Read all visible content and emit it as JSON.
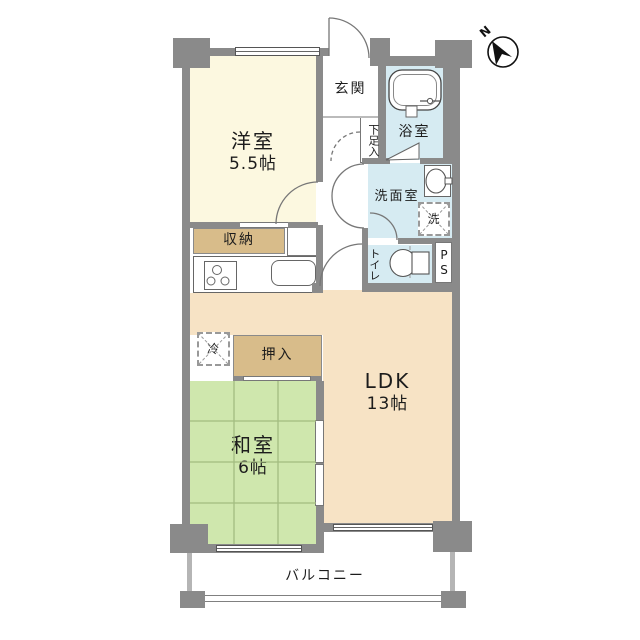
{
  "compass": {
    "north_label": "N"
  },
  "rooms": {
    "western_room": {
      "name": "洋室",
      "size": "5.5帖"
    },
    "ldk": {
      "name": "LDK",
      "size": "13帖"
    },
    "japanese_room": {
      "name": "和室",
      "size": "6帖"
    },
    "entrance": {
      "name": "玄関"
    },
    "bathroom": {
      "name": "浴室"
    },
    "washroom": {
      "name": "洗面室"
    },
    "toilet": {
      "name": "トイレ"
    },
    "balcony": {
      "name": "バルコニー"
    }
  },
  "features": {
    "shoe_cabinet": "下足入",
    "hall_storage": "収納",
    "futon_closet": "押入",
    "refrigerator_space": "冷",
    "washer_space": "洗",
    "pipe_space": "PS"
  },
  "colors": {
    "wall": "#8a8a8a",
    "western_room_floor": "#fcf8e0",
    "ldk_floor": "#f7e3c5",
    "japanese_room_floor": "#cfe7ad",
    "wet_area_floor": "#d6ebf2",
    "storage_fill": "#d8bc8a"
  }
}
